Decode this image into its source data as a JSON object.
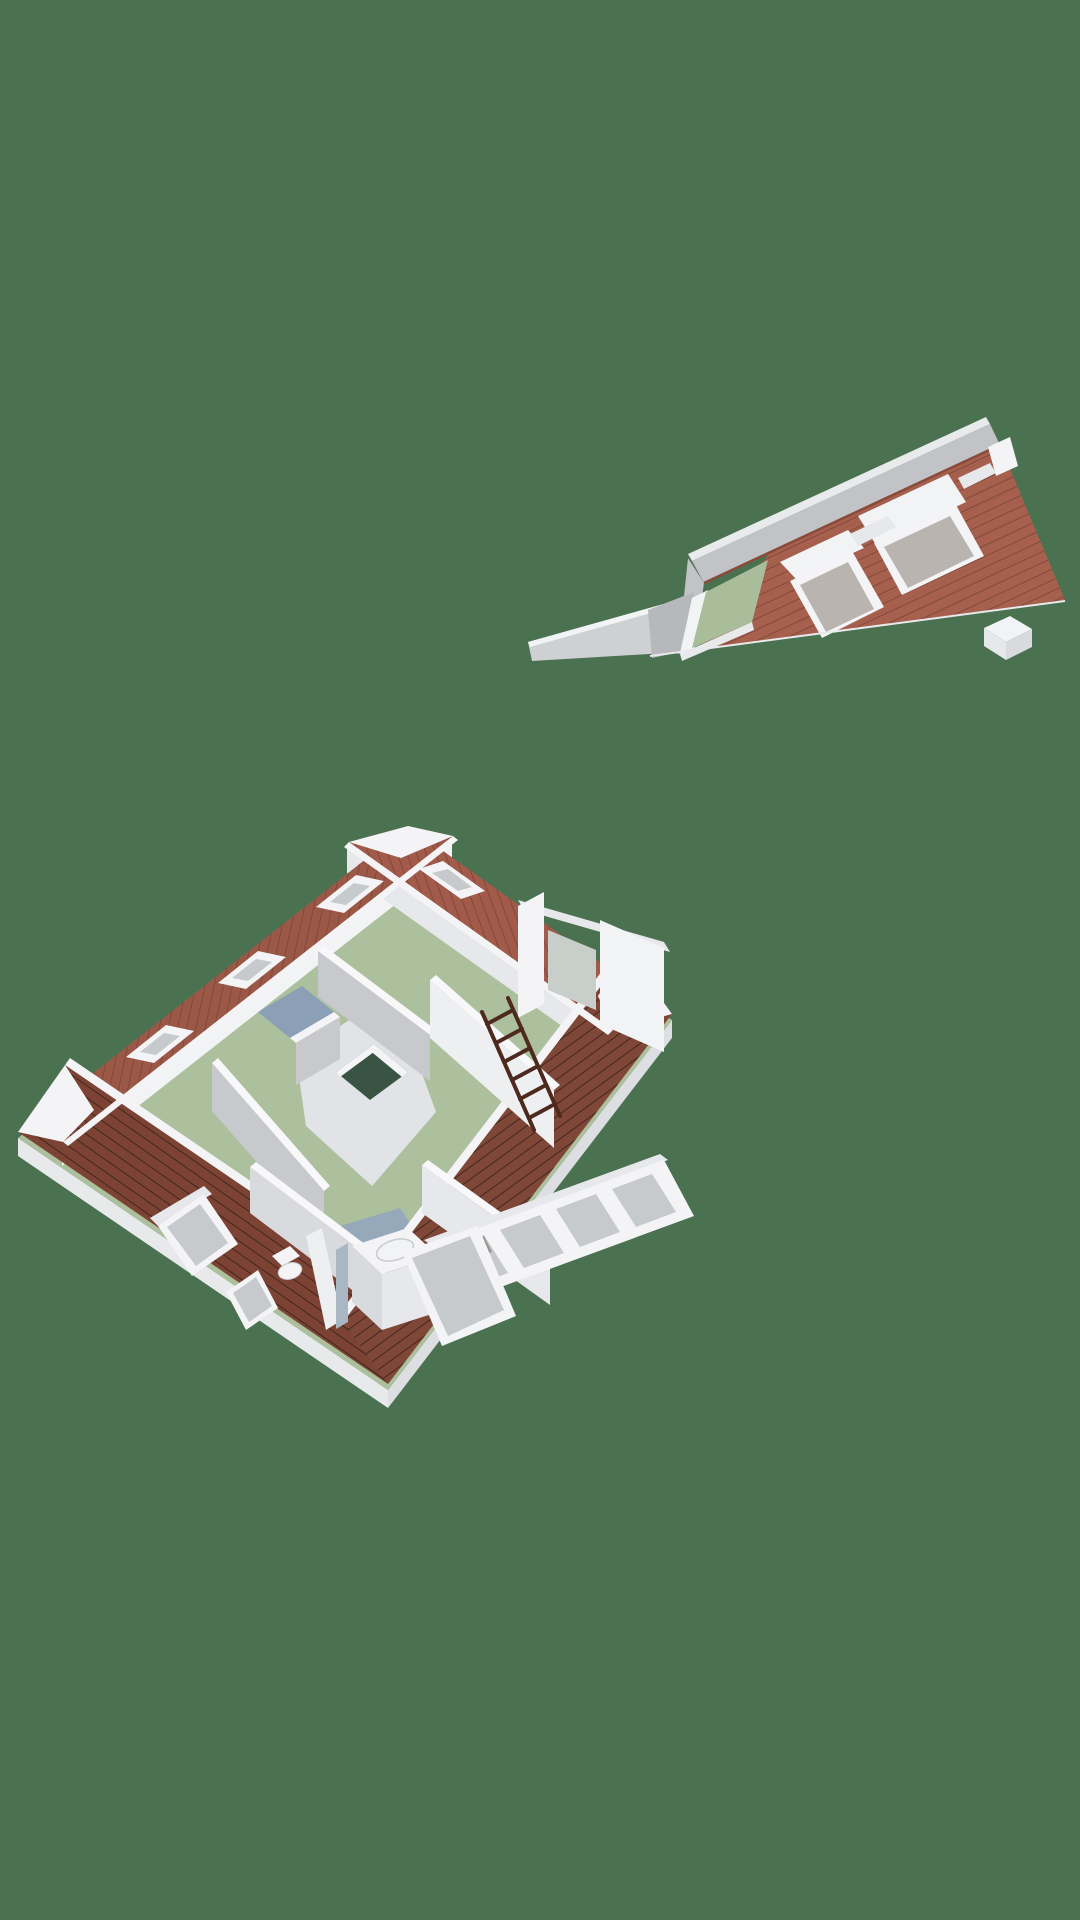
{
  "scene": {
    "description": "Isometric 3D floor plan render of an attic storey with a separate lifted-off roof section, on a plain green backdrop",
    "background_color": "#4A7150"
  },
  "palette": {
    "tileLight": "#A6604D",
    "tileLine": "#7E4638",
    "tileRowLine": "#8F5242",
    "tileNW": "#9C5847",
    "tileNE": "#A25B4A",
    "tileSW": "#7C4335",
    "tileSE": "#7F4737",
    "tileLineMid": "#7B4335",
    "tileLineSW": "#41251C",
    "tileLineDark": "#432620",
    "ridgeRed": "#8A4A3A",
    "capWhite": "#F4F4F6",
    "white": "#F2F3F5",
    "whiteBright": "#F8F8FA",
    "wallLit": "#EEEFF1",
    "wallLight": "#E7E8EB",
    "wallMid": "#D9DADD",
    "wallGray": "#C8C9CD",
    "wallDark": "#B7B8BC",
    "slabLight": "#E8E9EB",
    "slabDark": "#DDDEE1",
    "backSlope": "#C2C3C7",
    "backSliver": "#E9EAEB",
    "gableGray": "#CFD0D4",
    "floorGreen": "#ACC09D",
    "floorGreenA": "#A9BD9B",
    "floorBlue": "#96A9BA",
    "floorBlueDark": "#8BA0B6",
    "floorHall": "#E2E3E6",
    "stairHole": "#3A5443",
    "glassGray": "#C6CACD",
    "glassWarm": "#B9B4B0",
    "glassGreen": "#C8CEC9",
    "ladder": "#4E2A1E",
    "radiator": "#A9B6C4",
    "shadow": "#5A4038",
    "sinkLine": "#C9CACD"
  },
  "roof_section": {
    "id": "lifted-roof-section",
    "dormer_skylights": 2,
    "has_gable_cap": true,
    "has_chimney": true,
    "has_exposed_floor_strip": true
  },
  "attic_floor": {
    "rooms": [
      {
        "id": "bedroom-north",
        "floor": "green"
      },
      {
        "id": "bedroom-west",
        "floor": "green"
      },
      {
        "id": "attic-room-east",
        "floor": "green",
        "items": [
          "wooden-ladder"
        ]
      },
      {
        "id": "bathroom-south",
        "floor": "blue",
        "items": [
          "vanity-sink",
          "toilet",
          "door-leaf",
          "radiator"
        ]
      },
      {
        "id": "closet",
        "floor": "blue"
      },
      {
        "id": "landing",
        "floor": "light",
        "items": [
          "stairwell-opening"
        ]
      }
    ],
    "skylights": {
      "nw_band": 3,
      "ne_band": 1
    },
    "dormers": [
      "ne-dormer-window",
      "se-window-band-dormer",
      "sw-dormer-window",
      "bathroom-open-skylight",
      "bathroom-small-window"
    ],
    "ladder": {
      "rungs": 6,
      "rails": 2
    }
  }
}
